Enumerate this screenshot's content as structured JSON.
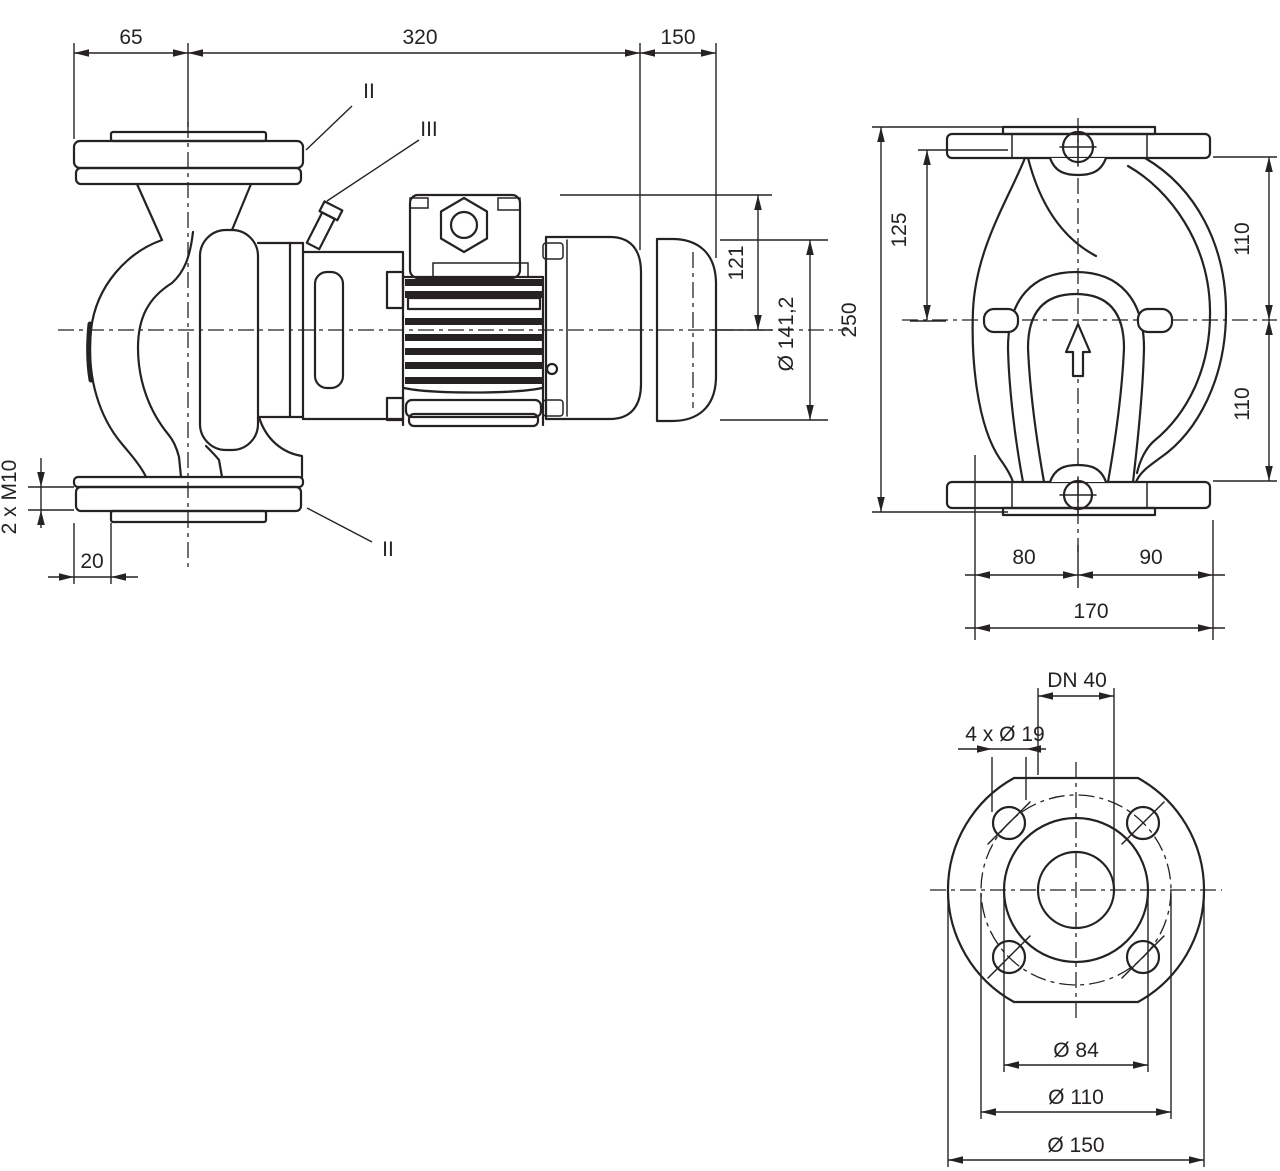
{
  "drawing": {
    "title": "pump-dimensional-drawing",
    "colors": {
      "line": "#262223",
      "background": "#ffffff"
    },
    "side_view": {
      "dim_width_left": "65",
      "dim_width_mid": "320",
      "dim_width_right": "150",
      "label_section_top": "II",
      "label_section_vent": "III",
      "label_section_bottom": "II",
      "dim_height_top": "121",
      "dim_fan_diameter": "Ø 141,2",
      "dim_foot_thread": "2 x M10",
      "dim_foot_offset": "20"
    },
    "front_view": {
      "dim_total_height": "250",
      "dim_upper_height": "125",
      "dim_flange_top": "110",
      "dim_flange_bottom": "110",
      "dim_foot_left": "80",
      "dim_foot_right": "90",
      "dim_total_width": "170"
    },
    "flange_view": {
      "dim_nominal": "DN 40",
      "dim_bolt_holes": "4 x Ø 19",
      "dim_raised_face": "Ø 84",
      "dim_bolt_circle": "Ø 110",
      "dim_outer": "Ø 150"
    }
  }
}
